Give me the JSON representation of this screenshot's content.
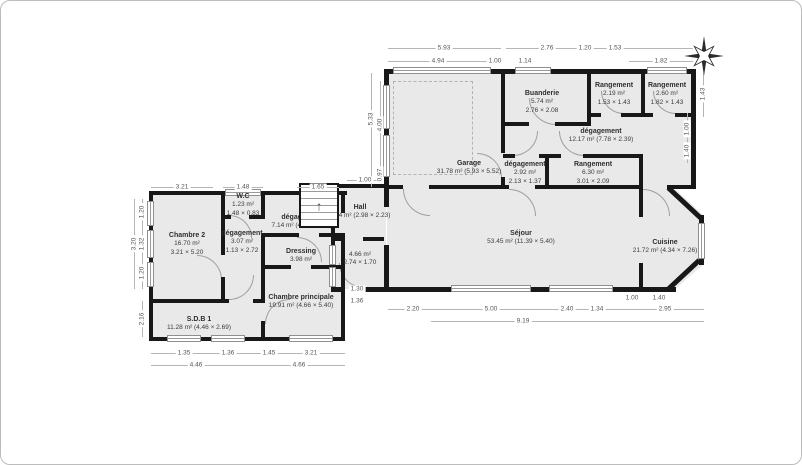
{
  "colors": {
    "wall": "#181818",
    "room_fill": "#e9e9e9",
    "dim_text": "#555555",
    "frame_border": "#bcbcbc"
  },
  "icons": {
    "compass": "compass-rose"
  },
  "rooms": [
    {
      "name": "Chambre 2",
      "area": "16.70 m²",
      "dims": "3.21 × 5.20"
    },
    {
      "name": "W.C",
      "area": "1.23 m²",
      "dims": "1.48 × 0.83"
    },
    {
      "name": "dégagement",
      "area": "3.07 m²",
      "dims": "1.13 × 2.72"
    },
    {
      "name": "dégagement",
      "area": "7.14 m² (4.80 × 2.64)",
      "dims": ""
    },
    {
      "name": "Dressing",
      "area": "3.98 m²",
      "dims": ""
    },
    {
      "name": "Chambre principale",
      "area": "19.91 m² (4.66 × 5.40)",
      "dims": ""
    },
    {
      "name": "S.D.B 1",
      "area": "11.28 m² (4.46 × 2.69)",
      "dims": ""
    },
    {
      "name": "Hall",
      "area": "6.64 m² (2.98 × 2.23)",
      "dims": ""
    },
    {
      "name": "",
      "area": "4.66 m²",
      "dims": "2.74 × 1.70"
    },
    {
      "name": "Garage",
      "area": "31.78 m² (5.93 × 5.52)",
      "dims": ""
    },
    {
      "name": "Buanderie",
      "area": "5.74 m²",
      "dims": "2.76 × 2.08"
    },
    {
      "name": "Rangement",
      "area": "2.19 m²",
      "dims": "1.53 × 1.43"
    },
    {
      "name": "Rangement",
      "area": "2.60 m²",
      "dims": "1.82 × 1.43"
    },
    {
      "name": "dégagement",
      "area": "12.17 m² (7.78 × 2.39)",
      "dims": ""
    },
    {
      "name": "dégagement",
      "area": "2.92 m²",
      "dims": "2.13 × 1.37"
    },
    {
      "name": "Rangement",
      "area": "6.30 m²",
      "dims": "3.01 × 2.09"
    },
    {
      "name": "Séjour",
      "area": "53.45 m² (11.39 × 5.40)",
      "dims": ""
    },
    {
      "name": "Cuisine",
      "area": "21.72 m² (4.34 × 7.26)",
      "dims": ""
    }
  ],
  "dims": {
    "rw_top": [
      "5.93",
      "4.94",
      "1.00",
      "1.14",
      "2.76",
      "1.20",
      "1.53",
      "1.82"
    ],
    "rw_left": [
      "5.33",
      "4.00",
      "0.97"
    ],
    "rw_right": [
      "1.43",
      "1.00",
      "1.40"
    ],
    "rw_bottom": [
      "2.20",
      "5.00",
      "2.40",
      "1.34",
      "9.19",
      "1.00",
      "1.40",
      "2.95"
    ],
    "lw_top": [
      "3.21",
      "1.48",
      "1.65",
      "1.00"
    ],
    "lw_left": [
      "1.20",
      "1.32",
      "1.20",
      "3.20",
      "2.16"
    ],
    "lw_front": [
      "1.30",
      "1.36"
    ],
    "lw_bottom": [
      "1.35",
      "1.36",
      "1.45",
      "3.21",
      "4.46",
      "4.66"
    ]
  }
}
